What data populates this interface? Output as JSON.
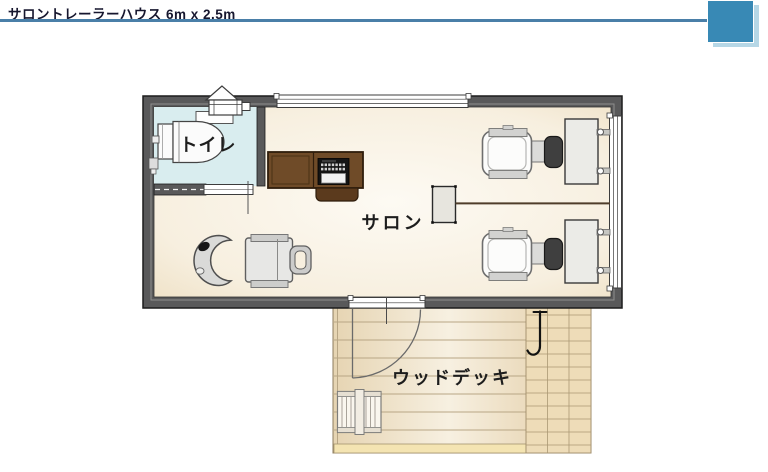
{
  "header": {
    "title": "サロントレーラーハウス 6m x 2.5m",
    "rule_color": "#4a7fa8",
    "corner_block_color": "#3889b5",
    "corner_block_shadow_color": "#b6d7e6"
  },
  "floorplan": {
    "wall_color": "#59595a",
    "rooms": {
      "toilet": {
        "label": "トイレ",
        "floor_color": "#d9edef"
      },
      "salon": {
        "label": "サロン",
        "floor_color": "#f7efdf"
      },
      "deck": {
        "label": "ウッドデッキ",
        "floor_color": "#ecdab6"
      }
    },
    "objects": [
      "roof-vent",
      "toilet-fixture",
      "toilet-shelf",
      "sliding-door",
      "reception-counter",
      "cash-register",
      "salon-partition",
      "divider-rail",
      "styling-chair-1",
      "styling-station-counter-1",
      "styling-chair-2",
      "styling-station-counter-2",
      "shampoo-bowl",
      "shampoo-chair",
      "entrance-door",
      "ribbon-window-top",
      "ribbon-window-right",
      "deck-bench",
      "garden-tap"
    ]
  }
}
